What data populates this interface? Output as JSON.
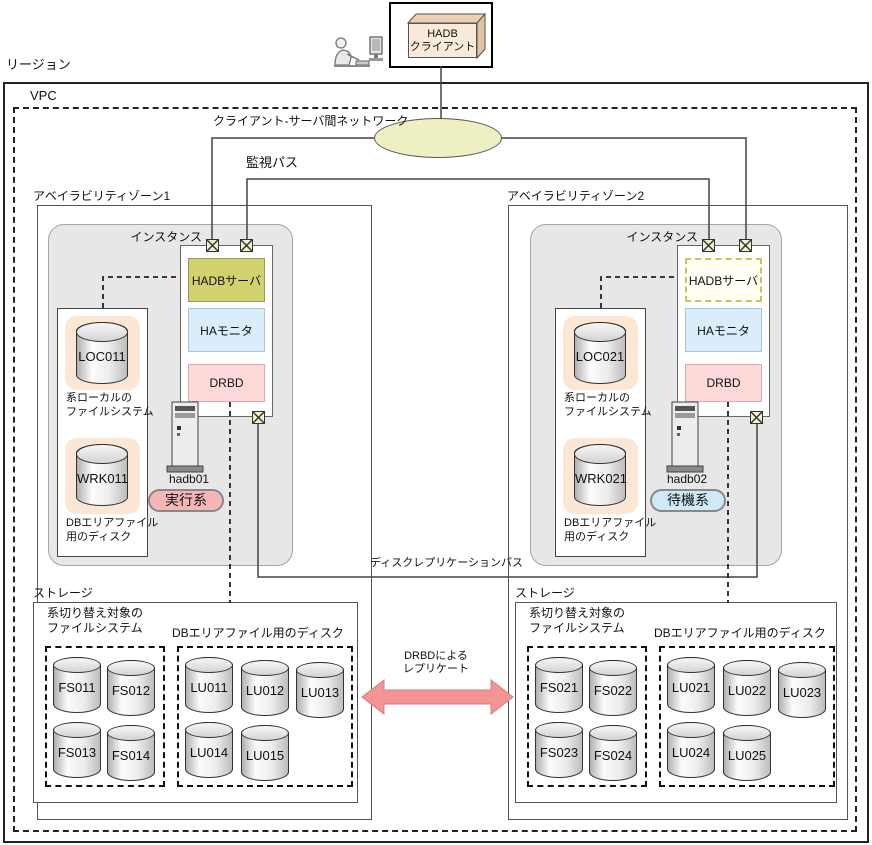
{
  "region_label": "リージョン",
  "vpc_label": "VPC",
  "client": {
    "line1": "HADB",
    "line2": "クライアント"
  },
  "network_label": "クライアント-サーバ間ネットワーク",
  "monitor_path_label": "監視パス",
  "disk_replication_path_label": "ディスクレプリケーションパス",
  "replication": {
    "line1": "DRBDによる",
    "line2": "レプリケート"
  },
  "zones": [
    {
      "label": "アベイラビリティゾーン1",
      "instance_label": "インスタンス",
      "hadb_server_label": "HADBサーバ",
      "ha_monitor_label": "HAモニタ",
      "drbd_label": "DRBD",
      "host": "hadb01",
      "role": "実行系",
      "local_disk_box": {
        "loc_disk": "LOC011",
        "loc_caption1": "系ローカルの",
        "loc_caption2": "ファイルシステム",
        "wrk_disk": "WRK011",
        "wrk_caption1": "DBエリアファイル",
        "wrk_caption2": "用のディスク"
      },
      "storage": {
        "label": "ストレージ",
        "fs_caption1": "系切り替え対象の",
        "fs_caption2": "ファイルシステム",
        "lu_caption": "DBエリアファイル用のディスク",
        "fs_disks": [
          "FS011",
          "FS012",
          "FS013",
          "FS014"
        ],
        "lu_disks": [
          "LU011",
          "LU012",
          "LU013",
          "LU014",
          "LU015"
        ]
      }
    },
    {
      "label": "アベイラビリティゾーン2",
      "instance_label": "インスタンス",
      "hadb_server_label": "HADBサーバ",
      "ha_monitor_label": "HAモニタ",
      "drbd_label": "DRBD",
      "host": "hadb02",
      "role": "待機系",
      "local_disk_box": {
        "loc_disk": "LOC021",
        "loc_caption1": "系ローカルの",
        "loc_caption2": "ファイルシステム",
        "wrk_disk": "WRK021",
        "wrk_caption1": "DBエリアファイル",
        "wrk_caption2": "用のディスク"
      },
      "storage": {
        "label": "ストレージ",
        "fs_caption1": "系切り替え対象の",
        "fs_caption2": "ファイルシステム",
        "lu_caption": "DBエリアファイル用のディスク",
        "fs_disks": [
          "FS021",
          "FS022",
          "FS023",
          "FS024"
        ],
        "lu_disks": [
          "LU021",
          "LU022",
          "LU023",
          "LU024",
          "LU025"
        ]
      }
    }
  ],
  "colors": {
    "active_box": "#d1d16e",
    "standby_box_border": "#c6c654",
    "ha_monitor_box": "#d9edfb",
    "drbd_box": "#fdd9d9",
    "network_ellipse": "#eef0c2",
    "nic_fill": "#f1f1cb",
    "active_badge": "#f7b6b6",
    "standby_badge": "#cfe9f8",
    "replication_arrow": "#f49494",
    "disk_pad": "#fbe7d4"
  }
}
